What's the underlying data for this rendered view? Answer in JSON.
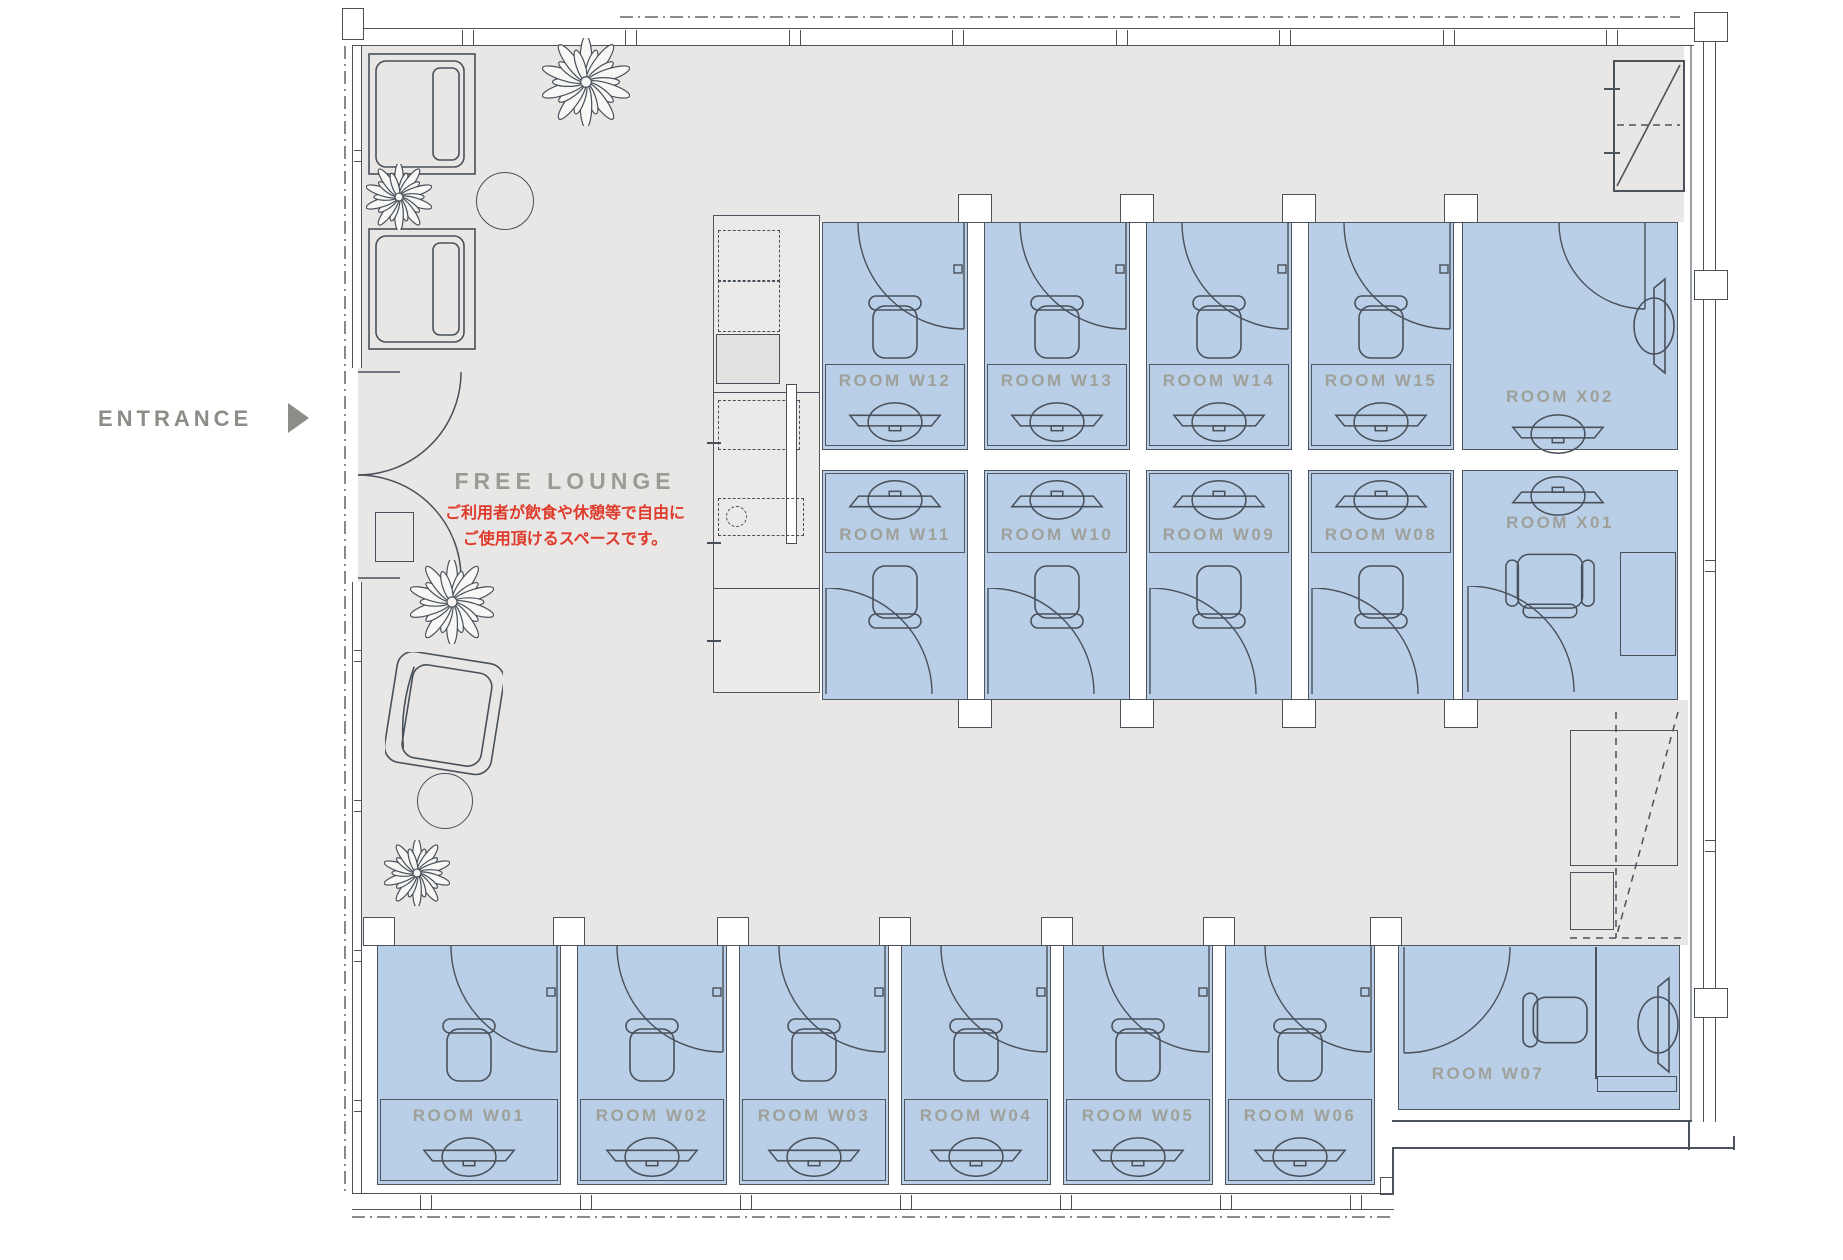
{
  "entrance": {
    "label": "ENTRANCE"
  },
  "lounge": {
    "title": "FREE LOUNGE",
    "note_line1": "ご利用者が飲食や休憩等で自由に",
    "note_line2": "ご使用頂けるスペースです。"
  },
  "rooms": [
    {
      "id": "w12",
      "label": "ROOM W12"
    },
    {
      "id": "w13",
      "label": "ROOM W13"
    },
    {
      "id": "w14",
      "label": "ROOM W14"
    },
    {
      "id": "w15",
      "label": "ROOM W15"
    },
    {
      "id": "x02",
      "label": "ROOM X02"
    },
    {
      "id": "w11",
      "label": "ROOM W11"
    },
    {
      "id": "w10",
      "label": "ROOM W10"
    },
    {
      "id": "w09",
      "label": "ROOM W09"
    },
    {
      "id": "w08",
      "label": "ROOM W08"
    },
    {
      "id": "x01",
      "label": "ROOM X01"
    },
    {
      "id": "w01",
      "label": "ROOM W01"
    },
    {
      "id": "w02",
      "label": "ROOM W02"
    },
    {
      "id": "w03",
      "label": "ROOM W03"
    },
    {
      "id": "w04",
      "label": "ROOM W04"
    },
    {
      "id": "w05",
      "label": "ROOM W05"
    },
    {
      "id": "w06",
      "label": "ROOM W06"
    },
    {
      "id": "w07",
      "label": "ROOM W07"
    }
  ],
  "colors": {
    "floor": "#e8e7e5",
    "room_fill": "#b9cfe7",
    "line": "#4e555e",
    "icon": "#49505a",
    "wall": "#4b525a",
    "label": "#9fa09a",
    "lounge_label": "#9b9b96",
    "entrance": "#8d8d88",
    "accent_red": "#df3a2b",
    "dash": "#8a8a8a",
    "white": "#ffffff"
  }
}
